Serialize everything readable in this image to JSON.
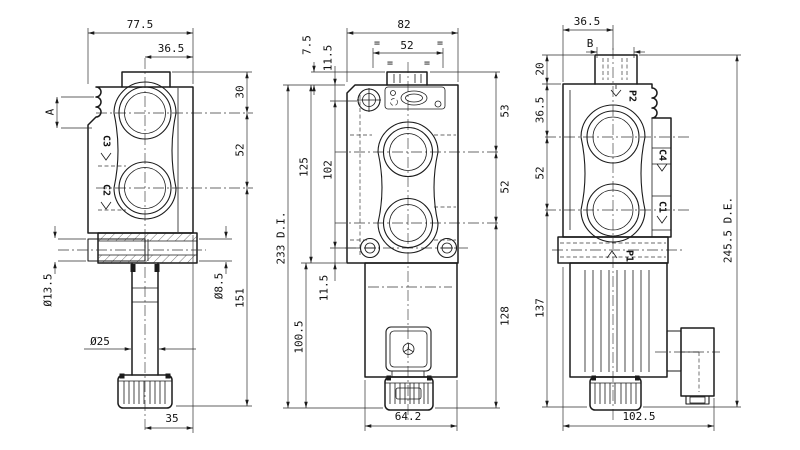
{
  "drawing": {
    "title": "directional-valve-three-view-dimension-drawing",
    "left_view": {
      "dims": {
        "total_width": "77.5",
        "center_to_edge": "36.5",
        "top_to_port": "30",
        "port_spacing": "52",
        "stem_length": "151",
        "handle_ref": "A",
        "clamp_dia": "Ø13.5",
        "hole_dia": "Ø8.5",
        "stem_dia": "Ø25",
        "knob_offset": "35"
      },
      "port_labels": {
        "top": "C3",
        "bottom": "C2"
      }
    },
    "front_view": {
      "dims": {
        "total_width": "82",
        "upper_spacing": "52",
        "tab_offset": "7.5",
        "plug_offset": "11.5",
        "top_to_port": "53",
        "port_spacing": "52",
        "body_height": "125",
        "chain_mid": "102",
        "overall_height": "233 D.I.",
        "screw_offset": "11.5",
        "solenoid_length": "100.5",
        "lower_height": "128",
        "solenoid_width": "64.2"
      },
      "symmetry_mark": "="
    },
    "side_view": {
      "dims": {
        "edge_to_center": "36.5",
        "tab_width": "B",
        "tab_height": "20",
        "top_to_port": "36.5",
        "port_spacing": "52",
        "lower_height": "137",
        "overall_height": "245.5 D.E.",
        "overall_width": "102.5"
      },
      "port_labels": {
        "pressure_top": "P2",
        "service_upper": "C4",
        "service_lower": "C1",
        "pressure_bottom": "P1"
      }
    }
  }
}
